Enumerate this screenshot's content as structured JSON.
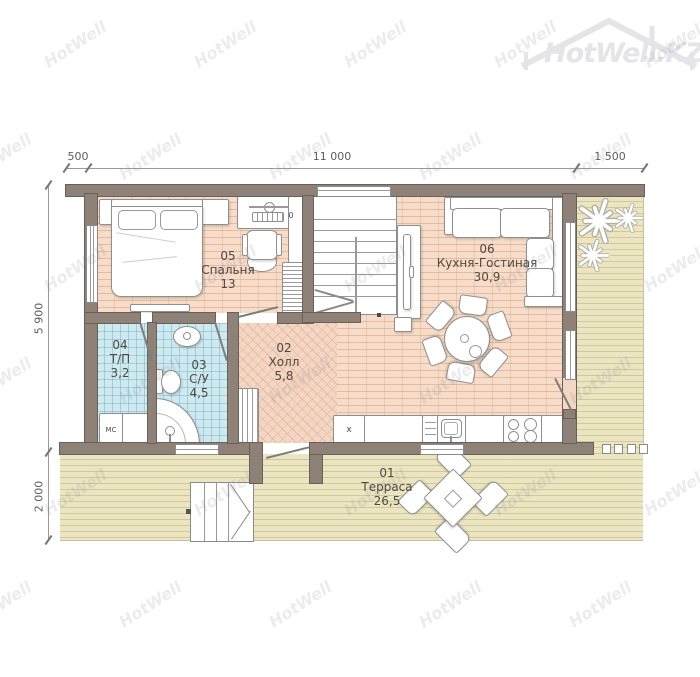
{
  "logo": {
    "text": "HotWell.KZ"
  },
  "watermark": {
    "text": "HotWell"
  },
  "dimensions": {
    "top": [
      "500",
      "11 000",
      "1 500"
    ],
    "left": [
      "5 900",
      "2 000"
    ]
  },
  "rooms": [
    {
      "number": "01",
      "name": "Терраса",
      "area": "26,5"
    },
    {
      "number": "02",
      "name": "Холл",
      "area": "5,8"
    },
    {
      "number": "03",
      "name": "С/У",
      "area": "4,5"
    },
    {
      "number": "04",
      "name": "Т/П",
      "area": "3,2"
    },
    {
      "number": "05",
      "name": "Спальня",
      "area": "13"
    },
    {
      "number": "06",
      "name": "Кухня-Гостиная",
      "area": "30,9"
    }
  ],
  "annotations": {
    "washing_machine": "МС",
    "fridge_mark": "x",
    "desk_mark": "0"
  },
  "colors": {
    "wall": "#8e8278",
    "wood_floor": "#f6dcc9",
    "hall_floor": "#f4d6c4",
    "tile_floor": "#cfe9f0",
    "deck_floor": "#ebe5c2",
    "furniture_outline": "#8f8f8f"
  }
}
